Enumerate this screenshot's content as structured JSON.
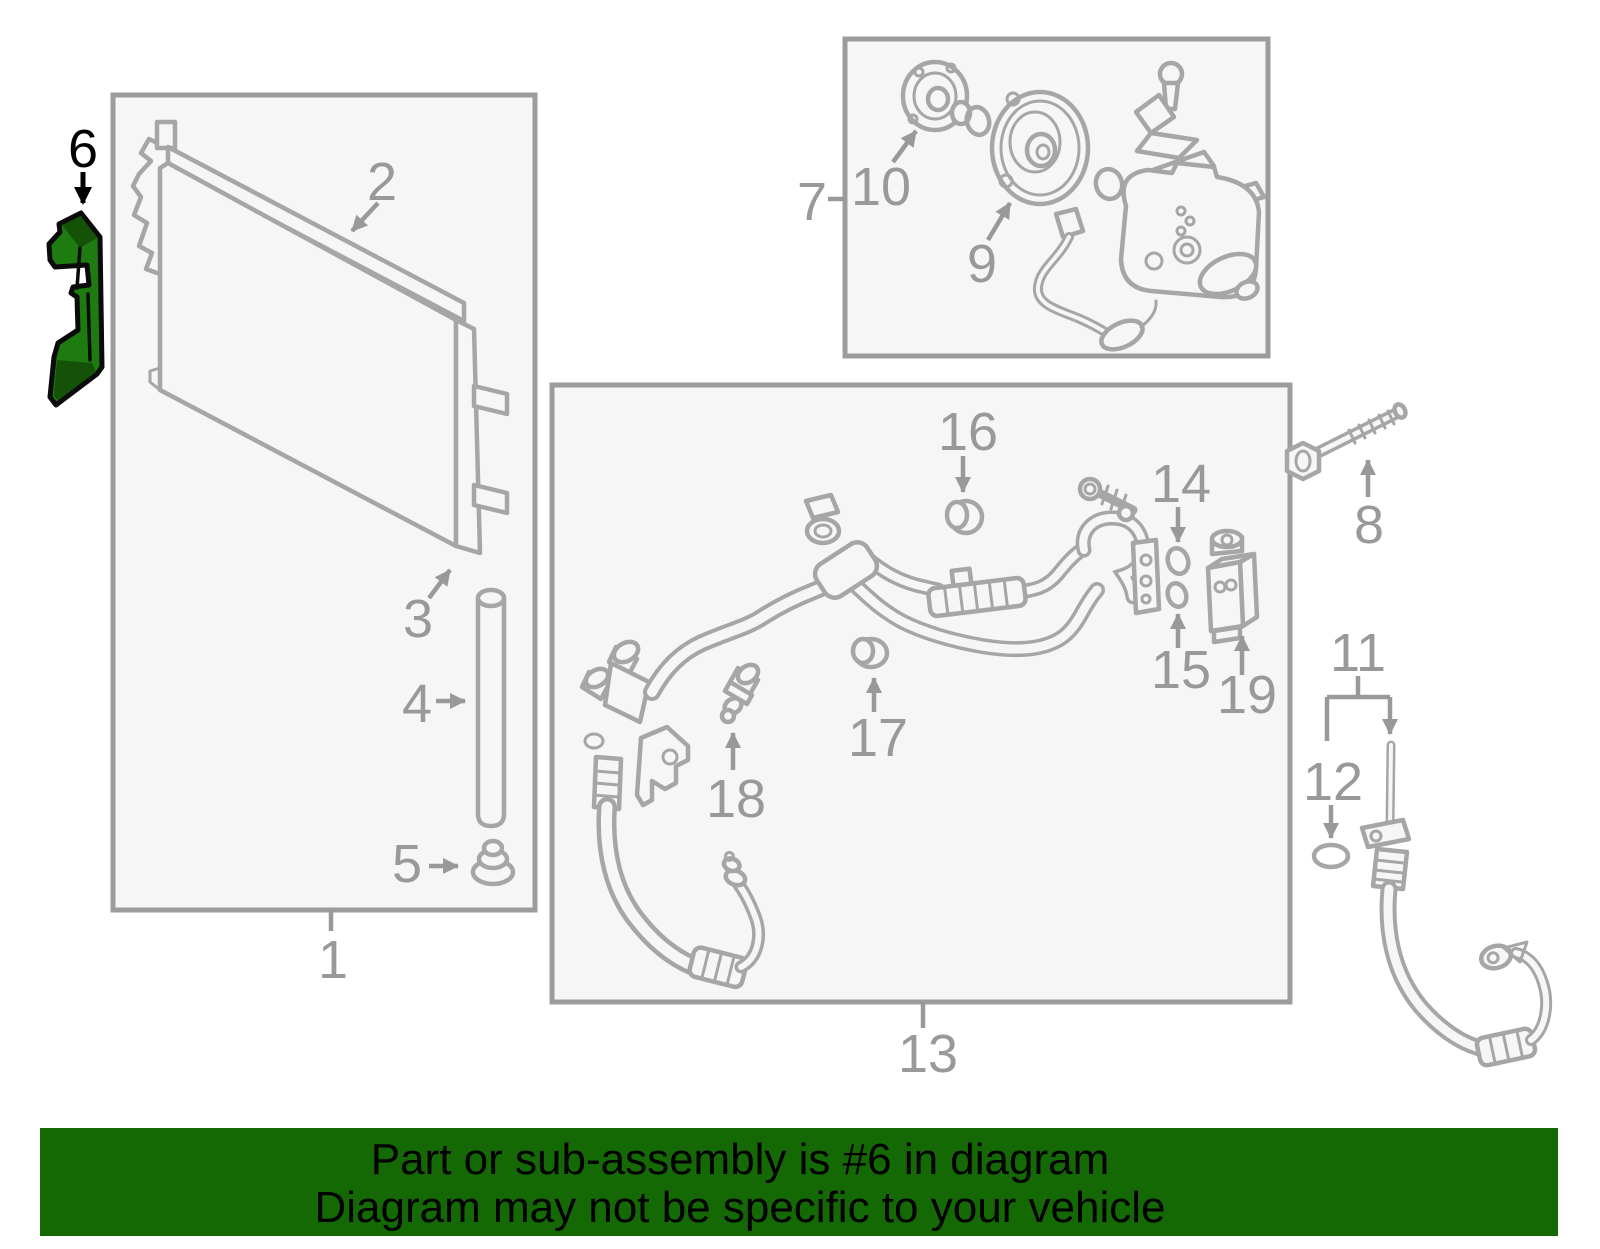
{
  "diagram": {
    "type": "parts-diagram",
    "subject": "A/C condenser, compressor and refrigerant line assembly",
    "highlighted_part": "6",
    "callouts": {
      "n1": "1",
      "n2": "2",
      "n3": "3",
      "n4": "4",
      "n5": "5",
      "n6": "6",
      "n7": "7",
      "n8": "8",
      "n9": "9",
      "n10": "10",
      "n11": "11",
      "n12": "12",
      "n13": "13",
      "n14": "14",
      "n15": "15",
      "n16": "16",
      "n17": "17",
      "n18": "18",
      "n19": "19"
    },
    "groups": [
      {
        "box": "condenser-box",
        "parent_label": "1",
        "member_labels": [
          "2",
          "3",
          "4",
          "5"
        ]
      },
      {
        "box": "compressor-box",
        "parent_label": "7",
        "member_labels": [
          "9",
          "10"
        ]
      },
      {
        "box": "lines-box",
        "parent_label": "13",
        "member_labels": [
          "14",
          "15",
          "16",
          "17",
          "18",
          "19"
        ]
      },
      {
        "box": "none",
        "member_labels": [
          "6",
          "8",
          "11",
          "12"
        ]
      }
    ]
  },
  "banner": {
    "line1": "Part or sub-assembly is #6 in diagram",
    "line2": "Diagram may not be specific to your vehicle"
  },
  "colors": {
    "highlight_green": "#1e7b10",
    "highlight_green_dark": "#135207",
    "banner_green": "#156905",
    "art_gray": "#a6a6a6",
    "label_gray": "#999999",
    "box_fill": "#f6f6f6",
    "box_border": "#9c9c9c",
    "label_black": "#000000"
  }
}
